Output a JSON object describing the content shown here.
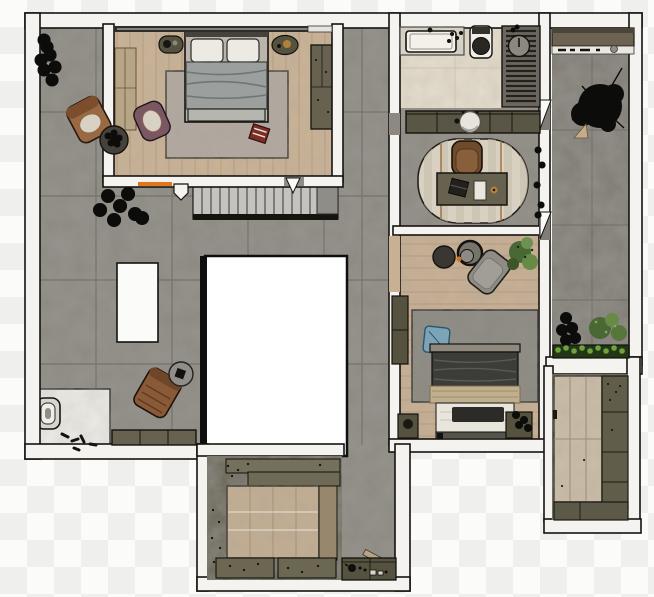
{
  "canvas": {
    "width": 654,
    "height": 597,
    "viewbox": "0 0 654 597",
    "background": "checkerboard"
  },
  "colors": {
    "bg1": "#fbfbfa",
    "bg2": "#efefed",
    "wall": "#f4f3ef",
    "line": "#15130f",
    "conc": "#8d8982",
    "concD": "#817c74",
    "concGrid": "#55524b",
    "wood1": "#cab396",
    "plank1": "#ab8f6f",
    "wood2": "#c8b094",
    "plank2": "#a98e6f",
    "wood3": "#c2ae92",
    "woodBR": "#cbbda7",
    "woodStrip": "#97876d",
    "bath": "#e5ddcc",
    "bathLine": "#cdc4ae",
    "cab": "#66624f",
    "cabL": "#74705c",
    "cabD": "#55523f",
    "vanity": "#5a5646",
    "rug1": "#b2a9a0",
    "rug2": "#8b8981",
    "oval": "#d8d1c1",
    "ovalStripe": "#c9c0ad",
    "rust": "#a8784a",
    "void": "#ffffff",
    "island": "#fbfbf9",
    "alcove": "#ecebe6",
    "stair": "#c4c3c0",
    "stairLine": "#504e47",
    "mat": "#8e8d88",
    "bedframe1": "#b9b5ad",
    "head1": "#454239",
    "duvet1": "#9aa09f",
    "duvetLn1": "#6f7674",
    "pillow": "#eceae3",
    "foot1": "#b6b6b0",
    "head2": "#8f887c",
    "duvet2": "#3c3c38",
    "duvetLn2": "#5a5a52",
    "blanket": "#c0af8e",
    "blanketLn": "#a08c68",
    "sheet": "#e8e5db",
    "rail": "#55534b",
    "tray2": "#2c2b27",
    "blue": "#7da4b6",
    "blueLn": "#27576b",
    "cognac": "#9a6942",
    "cognacD": "#7d4e2d",
    "cushion": "#d9d2c4",
    "mauve": "#7b5761",
    "brown": "#8a5a38",
    "brownD": "#6f4628",
    "grayChair": "#8e8c85",
    "chairBr": "#6f4b2d",
    "chairBrIn": "#875f3b",
    "pad": "#e9e6de",
    "gold": "#b08239",
    "black": "#0c0c0a",
    "green1": "#4a6836",
    "green2": "#678a47",
    "green3": "#84a75e",
    "hedge": "#233618",
    "hedgeLeaf": "#6ea23c",
    "orange": "#e0771f",
    "orangeDot": "#cf7327",
    "red": "#7c2e24",
    "shower": "#6b675f",
    "slat": "#24211c",
    "stool": "#8b8880",
    "tub": "#f3f1ea",
    "porcelain": "#f0eee8",
    "seat": "#2a2723",
    "glaze": "#2f2d27",
    "tan": "#b7a587",
    "tableGray": "#8f8e89",
    "tableDark": "#45423c"
  },
  "scene": {
    "type": "floor-plan-top-view",
    "rooms": [
      {
        "id": "master-bedroom",
        "items": [
          "double-bed",
          "pillows",
          "area-rug",
          "wardrobe",
          "wall-bench",
          "nightstand-left",
          "nightstand-right",
          "mauve-armchair",
          "red-floor-tray",
          "window-glazing",
          "orange-wall-vent"
        ]
      },
      {
        "id": "living-area",
        "items": [
          "kitchen-island",
          "cognac-armchair",
          "plant-side-table",
          "leather-armchair",
          "round-side-table",
          "storage-bench",
          "corner-plant",
          "floor-plant",
          "scattered-shoes",
          "staircase",
          "central-void",
          "toilet-alcove",
          "toilet"
        ]
      },
      {
        "id": "bathroom",
        "items": [
          "counter",
          "bathtub",
          "toiletries",
          "toilet",
          "walk-in-shower",
          "shower-stool"
        ]
      },
      {
        "id": "vanity-hall",
        "items": [
          "vanity-counter",
          "round-basin"
        ]
      },
      {
        "id": "study-nook",
        "items": [
          "oval-rug",
          "desk",
          "laptop",
          "notepad",
          "desk-chair",
          "wall-plants"
        ]
      },
      {
        "id": "bedroom-2",
        "items": [
          "double-bed",
          "dark-duvet",
          "tan-blanket",
          "white-sheet",
          "tv-tray",
          "blue-cushion",
          "area-rug",
          "round-coffee-table",
          "ring-side-table",
          "lounge-chair",
          "potted-plant",
          "wardrobe-niche",
          "nightstand-left",
          "nightstand-right"
        ]
      },
      {
        "id": "balcony-garden",
        "items": [
          "storage-shelf",
          "large-potted-tree",
          "black-shrub",
          "green-plants",
          "hedge-planter",
          "balcony-door-upper",
          "balcony-door-lower"
        ]
      },
      {
        "id": "walk-in-closet-right",
        "items": [
          "wood-panel-doors",
          "cabinet-column",
          "low-cabinet-row",
          "door-handle"
        ]
      },
      {
        "id": "walk-in-closet-bottom",
        "items": [
          "perimeter-cabinets",
          "wood-floor-inlay",
          "shelf-row-upper",
          "shelf-row-lower",
          "lower-cabinets",
          "cleaning-stick"
        ]
      },
      {
        "id": "service-corridor",
        "items": [
          "counter",
          "kettle",
          "small-appliances"
        ]
      }
    ]
  }
}
